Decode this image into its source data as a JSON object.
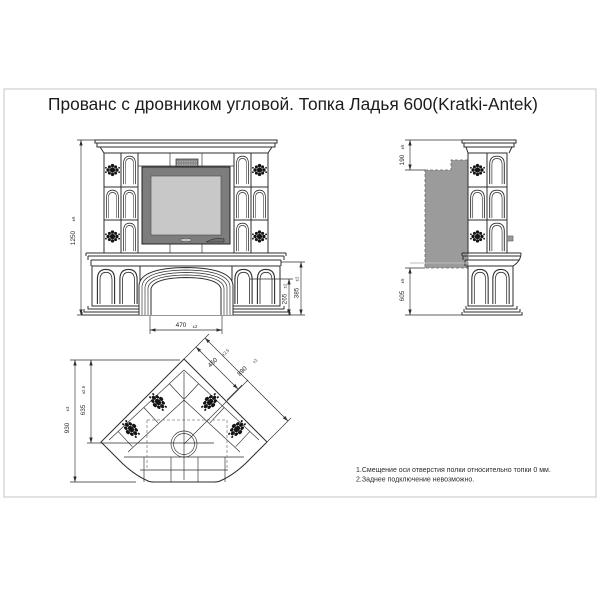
{
  "title": "Прованс с дровником угловой. Топка Ладья 600(Kratki-Antek)",
  "front_view": {
    "height": {
      "v": "1250",
      "t": "±5"
    },
    "opening_width": {
      "v": "470",
      "t": "±2"
    },
    "arch_springer_height": {
      "v": "265",
      "t": "±2"
    },
    "arch_apex_height": {
      "v": "385",
      "t": "±2"
    }
  },
  "side_view": {
    "flue_top_offset": {
      "v": "190",
      "t": "±5"
    },
    "base_height": {
      "v": "605",
      "t": "±5"
    }
  },
  "plan_view": {
    "overall_depth": {
      "v": "930",
      "t": "±3"
    },
    "corner_to_front": {
      "v": "635",
      "t": "±2.5"
    },
    "firebox_width": {
      "v": "450",
      "t": "±2.5"
    },
    "facade_width": {
      "v": "890",
      "t": "±2"
    }
  },
  "notes": [
    "1.Смещение оси отверстия полки относительно топки 0 мм.",
    "2.Заднее подключение невозможно."
  ],
  "colors": {
    "line": "#2e2e2e",
    "firebox_body": "#7d7d7d",
    "firebox_glass": "#c8c8c8",
    "hidden_mass": "#9b9b9b",
    "ornament": "#141414"
  }
}
